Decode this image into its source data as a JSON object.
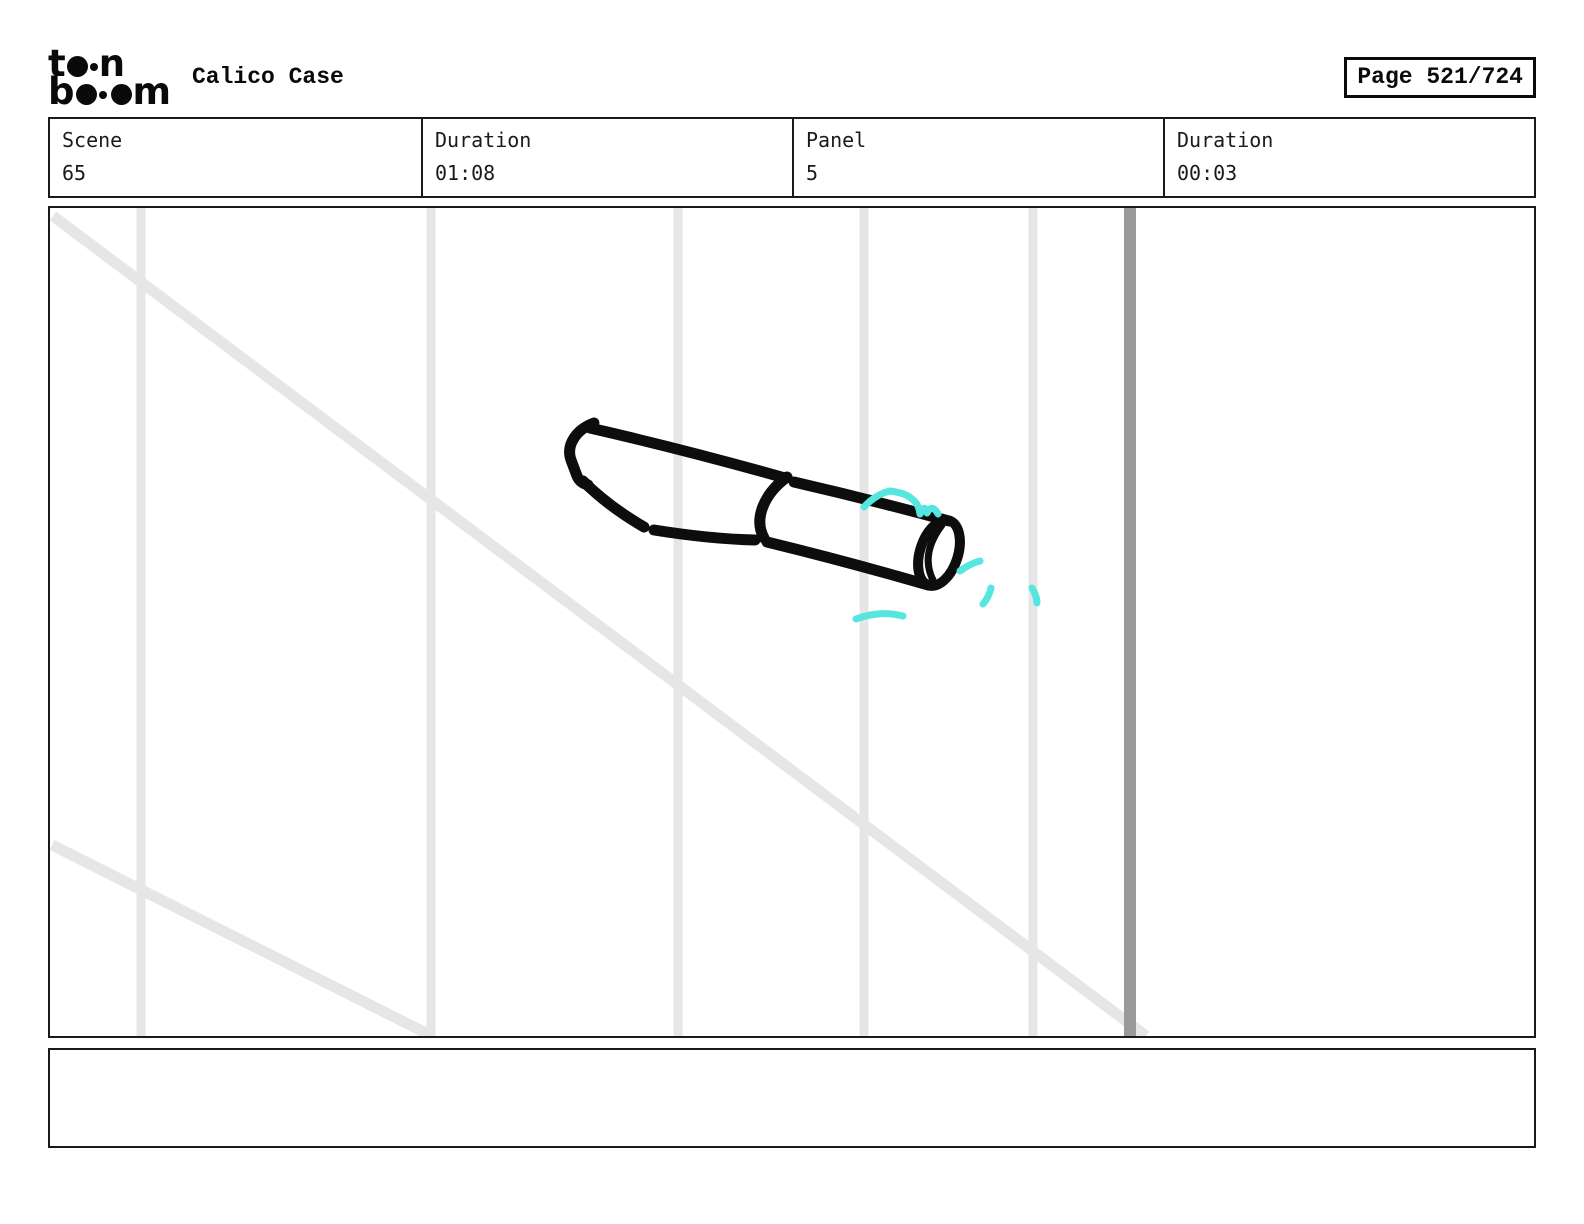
{
  "header": {
    "logo": {
      "alt": "toon boom",
      "l1a": "t",
      "l1b": "n",
      "l2a": "b",
      "l2b": "m"
    },
    "title": "Calico Case",
    "page_label": "Page 521/724"
  },
  "info_bar": {
    "cells": [
      {
        "label": "Scene",
        "value": "65"
      },
      {
        "label": "Duration",
        "value": "01:08"
      },
      {
        "label": "Panel",
        "value": "5"
      },
      {
        "label": "Duration",
        "value": "00:03"
      }
    ]
  },
  "panel": {
    "caption_text": ""
  },
  "colors": {
    "sketch_black": "#0d0d0d",
    "accent_cyan": "#55e6df",
    "guide_light": "#e6e6e6",
    "guide_dark": "#9a9a9a"
  }
}
